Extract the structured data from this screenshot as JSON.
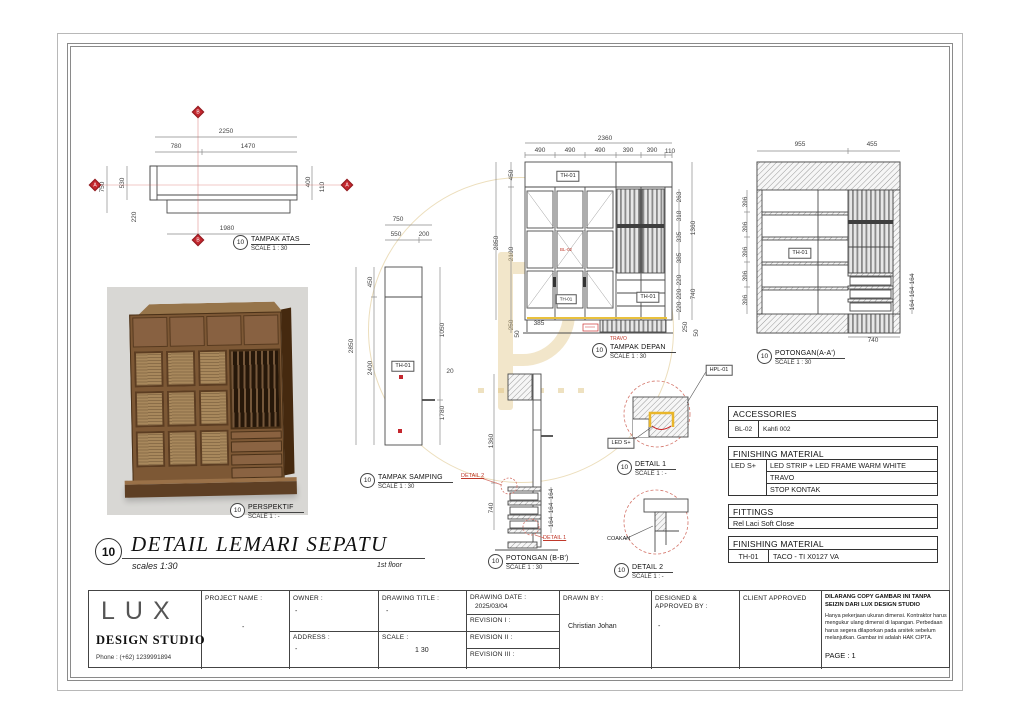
{
  "main_title": {
    "number": "10",
    "title": "DETAIL LEMARI SEPATU",
    "scale_note": "scales 1:30",
    "floor_note": "1st floor"
  },
  "views": {
    "tampak_atas": {
      "number": "10",
      "name": "TAMPAK ATAS",
      "scale": "SCALE 1 : 30",
      "dims": {
        "top": "2250",
        "top_a": "780",
        "top_b": "1470",
        "left_a": "750",
        "left_b": "530",
        "left_c": "220",
        "right_a": "400",
        "right_b": "110",
        "bottom": "1980"
      },
      "markers": {
        "top": "B",
        "left": "A",
        "right": "A",
        "bottom": "B"
      }
    },
    "tampak_samping": {
      "number": "10",
      "name": "TAMPAK SAMPING",
      "scale": "SCALE 1 : 30",
      "tag": "TH-01",
      "dims": {
        "top": "750",
        "top_a": "550",
        "top_b": "200",
        "left": "2850",
        "left_a": "450",
        "left_b": "2400",
        "right_a": "1050",
        "right_b": "20",
        "right_c": "1780"
      }
    },
    "tampak_depan": {
      "number": "10",
      "name": "TAMPAK DEPAN",
      "scale": "SCALE 1 : 30",
      "tag_top": "TH-01",
      "tag_mid": "TH-01",
      "tag_right": "TH-01",
      "note_handle": "BL-02",
      "note_travo": "TRAVO",
      "dims": {
        "top": "2360",
        "col_a": "490",
        "col_b": "490",
        "col_c": "490",
        "col_d": "390",
        "col_e": "390",
        "col_f": "110",
        "left": "2850",
        "left_a": "450",
        "left_b": "2100",
        "left_c": "250",
        "left_d": "50",
        "shelf_a": "620",
        "shelf_b": "620",
        "shelf_c": "620",
        "inner": "385",
        "right_a": "263",
        "right_b": "318",
        "right_c": "335",
        "right_d": "385",
        "right_total": "1360",
        "drawer_a": "220",
        "drawer_b": "220",
        "drawer_c": "220",
        "drawer_total": "740",
        "base_a": "250",
        "base_b": "50"
      }
    },
    "potongan_aa": {
      "number": "10",
      "name": "POTONGAN(A-A')",
      "scale": "SCALE 1 : 30",
      "tag": "TH-01",
      "dims": {
        "top_a": "955",
        "top_b": "455",
        "left_a": "396",
        "left_b": "396",
        "left_c": "396",
        "left_d": "396",
        "left_e": "396",
        "right_a": "164",
        "right_b": "164",
        "right_c": "164",
        "bottom": "740"
      }
    },
    "potongan_bb": {
      "number": "10",
      "name": "POTONGAN (B-B')",
      "scale": "SCALE 1 : 30",
      "detail_1": "DETAIL 1",
      "detail_2": "DETAIL 2",
      "dims": {
        "upper": "1360",
        "lower": "740",
        "right_a": "164",
        "right_b": "164",
        "right_c": "164"
      }
    },
    "detail_1": {
      "number": "10",
      "name": "DETAIL 1",
      "scale": "SCALE 1 : -",
      "callout_hpl": "HPL-01",
      "callout_led": "LED S+"
    },
    "detail_2": {
      "number": "10",
      "name": "DETAIL 2",
      "scale": "SCALE 1 : -",
      "callout": "COAKAN"
    },
    "perspektif": {
      "number": "10",
      "name": "PERSPEKTIF",
      "scale": "SCALE 1 : -"
    }
  },
  "tables": {
    "accessories": {
      "header": "ACCESSORIES",
      "code": "BL-02",
      "desc": "Kahfi 002"
    },
    "finishing_1": {
      "header": "FINISHING MATERIAL",
      "code": "LED S+",
      "row_a": "LED STRIP + LED FRAME WARM WHITE",
      "row_b": "TRAVO",
      "row_c": "STOP KONTAK"
    },
    "fittings": {
      "header": "FITTINGS",
      "row": "Rel Laci Soft Close"
    },
    "finishing_2": {
      "header": "FINISHING MATERIAL",
      "code": "TH-01",
      "desc": "TACO - TI X0127 VA"
    }
  },
  "title_block": {
    "company": {
      "name": "LUX",
      "subtitle": "DESIGN STUDIO",
      "phone": "Phone : (+62) 1239991894"
    },
    "project_name_label": "PROJECT NAME :",
    "project_name_value": "-",
    "owner_label": "OWNER :",
    "owner_value": "-",
    "address_label": "ADDRESS :",
    "address_value": "-",
    "drawing_title_label": "DRAWING TITLE :",
    "drawing_title_value": "-",
    "scale_label": "SCALE :",
    "scale_value": "1 30",
    "drawing_date_label": "DRAWING DATE :",
    "drawing_date_value": "2025/03/04",
    "revision_1_label": "REVISION I :",
    "revision_2_label": "REVISION II :",
    "revision_3_label": "REVISION III :",
    "drawn_by_label": "DRAWN BY :",
    "drawn_by_value": "Christian Johan",
    "designed_label": "DESIGNED & APPROVED  BY :",
    "designed_value": "-",
    "client_approved_label": "CLIENT APPROVED",
    "disclaimer_title": "DILARANG COPY GAMBAR INI TANPA SEIZIN DARI LUX DESIGN STUDIO",
    "disclaimer_body": "Hanya pekerjaan ukuran dimensi. Kontraktor harus mengukur ulang dimensi di lapangan. Perbedaan harus segera dilaporkan pada arsitek sebelum melanjutkan. Gambar ini adalah HAK CIPTA.",
    "page": "PAGE : 1"
  }
}
